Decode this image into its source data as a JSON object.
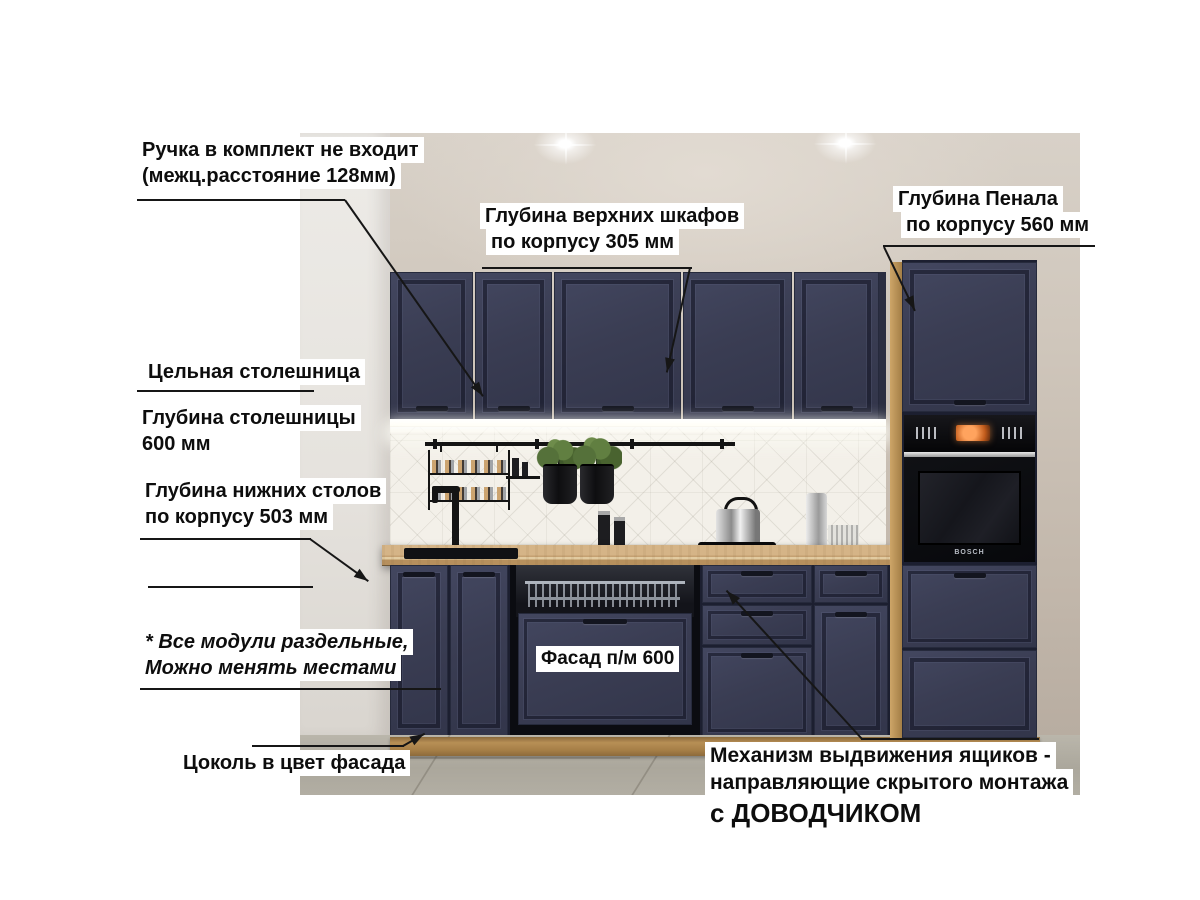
{
  "annotations": {
    "handle_note": {
      "line1": "Ручка в комплект не входит",
      "line2": "(межц.расстояние 128мм)"
    },
    "upper_depth": {
      "line1": "Глубина верхних шкафов",
      "line2": "по корпусу 305 мм"
    },
    "penal_depth": {
      "line1": "Глубина Пенала",
      "line2": "по корпусу 560 мм"
    },
    "worktop_solid": {
      "line1": "Цельная столешница"
    },
    "worktop_depth": {
      "line1": "Глубина столешницы",
      "line2": "600 мм"
    },
    "base_depth": {
      "line1": "Глубина нижних столов",
      "line2": "по корпусу 503 мм"
    },
    "modules_note": {
      "line1": "* Все модули раздельные,",
      "line2": "Можно менять местами"
    },
    "plinth_note": {
      "line1": "Цоколь в цвет фасада"
    },
    "facade_note": {
      "line1": "Фасад п/м 600"
    },
    "mechanism_note": {
      "line1": "Механизм выдвижения ящиков -",
      "line2": "направляющие скрытого монтажа",
      "line3": "с ДОВОДЧИКОМ"
    }
  },
  "appliances": {
    "oven_brand": "BOSCH"
  },
  "colors": {
    "cabinet_navy": "#3a3d52",
    "countertop_wood": "#c9a87a",
    "plinth_wood": "#a8824a",
    "wall_beige": "#cfc5ba",
    "backsplash_white": "#f3f0e9",
    "floor_gray": "#aeaaa0",
    "annotation_text": "#0d0d0d",
    "annotation_bg": "#ffffff",
    "arrow_black": "#161616"
  }
}
